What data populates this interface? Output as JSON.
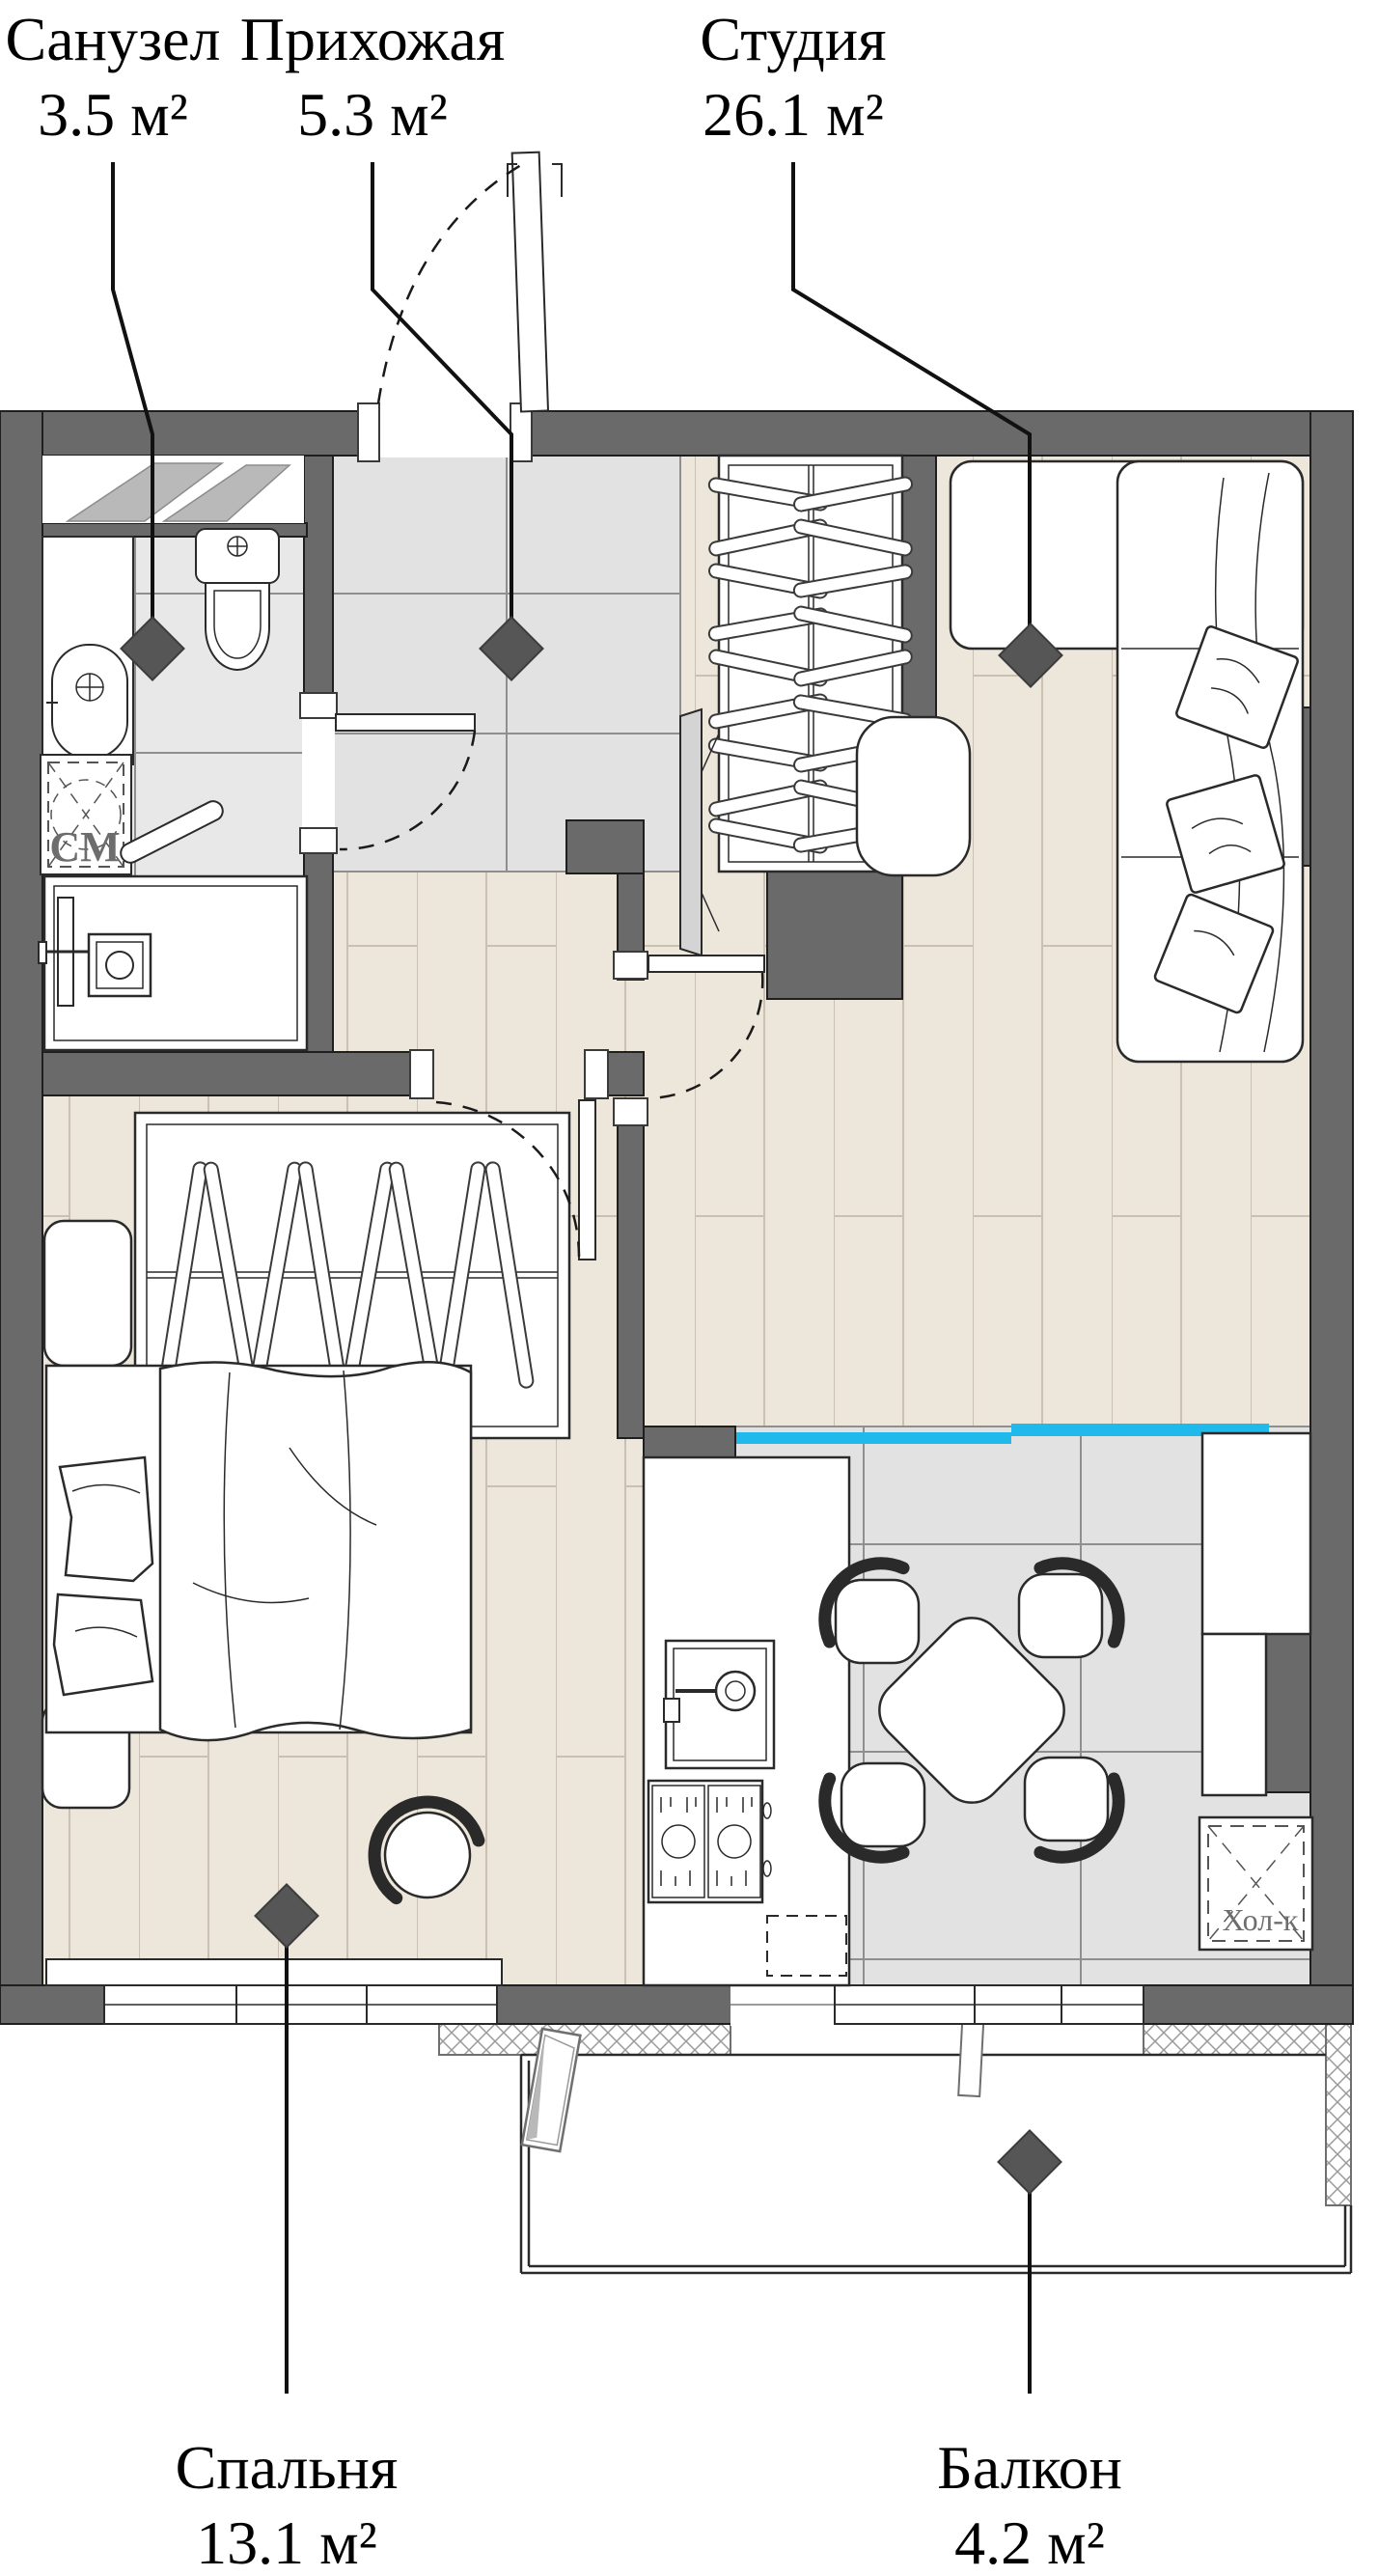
{
  "plan": {
    "type": "apartment-floor-plan",
    "room_labels": [
      {
        "id": "bathroom",
        "name": "Санузел",
        "area": "3.5 м²"
      },
      {
        "id": "hallway",
        "name": "Прихожая",
        "area": "5.3 м²"
      },
      {
        "id": "studio",
        "name": "Студия",
        "area": "26.1 м²"
      },
      {
        "id": "bedroom",
        "name": "Спальня",
        "area": "13.1 м²"
      },
      {
        "id": "balcony",
        "name": "Балкон",
        "area": "4.2 м²"
      }
    ],
    "fixture_labels": {
      "washing_machine": "СМ",
      "refrigerator": "Хол-к"
    },
    "markers": {
      "icon": "diamond-marker-icon",
      "count": 5
    },
    "colors": {
      "wall": "#6a6a6a",
      "wood_floor": "#ede6da",
      "tile_floor": "#e2e2e2",
      "kitchen_highlight": "#1fb9ec",
      "marker": "#565656",
      "line": "#1a1a1a"
    }
  }
}
